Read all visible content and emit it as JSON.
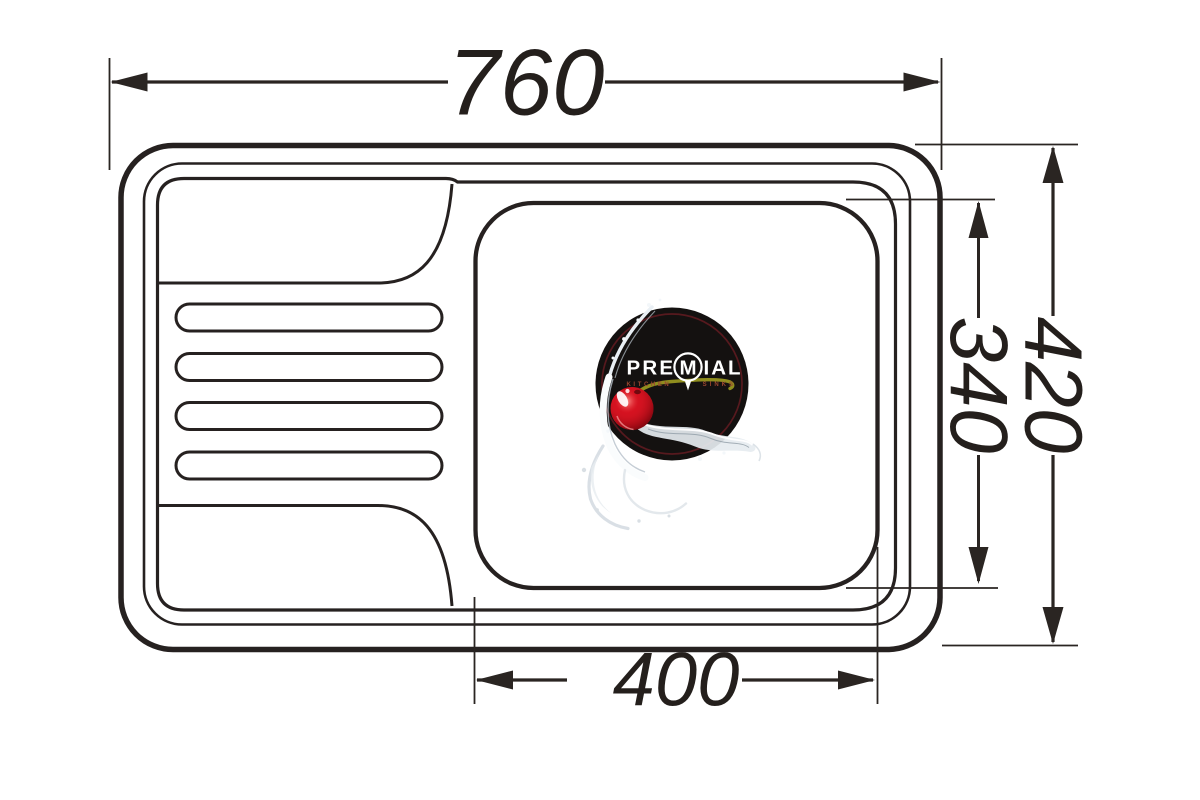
{
  "drawing": {
    "background": "#ffffff",
    "line_color": "#262120",
    "dimensions": {
      "overall_width": "760",
      "overall_depth": "420",
      "bowl_depth": "340",
      "bowl_width": "400"
    },
    "logo": {
      "brand_full": "PREMIAL",
      "brand_pre": "PRE",
      "brand_m": "M",
      "brand_ial": "IAL",
      "tagline_left": "KITCHEN",
      "tagline_right": "SINKS",
      "colors": {
        "badge": "#141110",
        "inner_ring": "#5e1b20",
        "brand_text": "#ffffff",
        "tagline_text": "#9a4630",
        "cherry": "#d2101f",
        "stem": "#8f8d1e",
        "splash": "#d5dce2"
      }
    }
  }
}
